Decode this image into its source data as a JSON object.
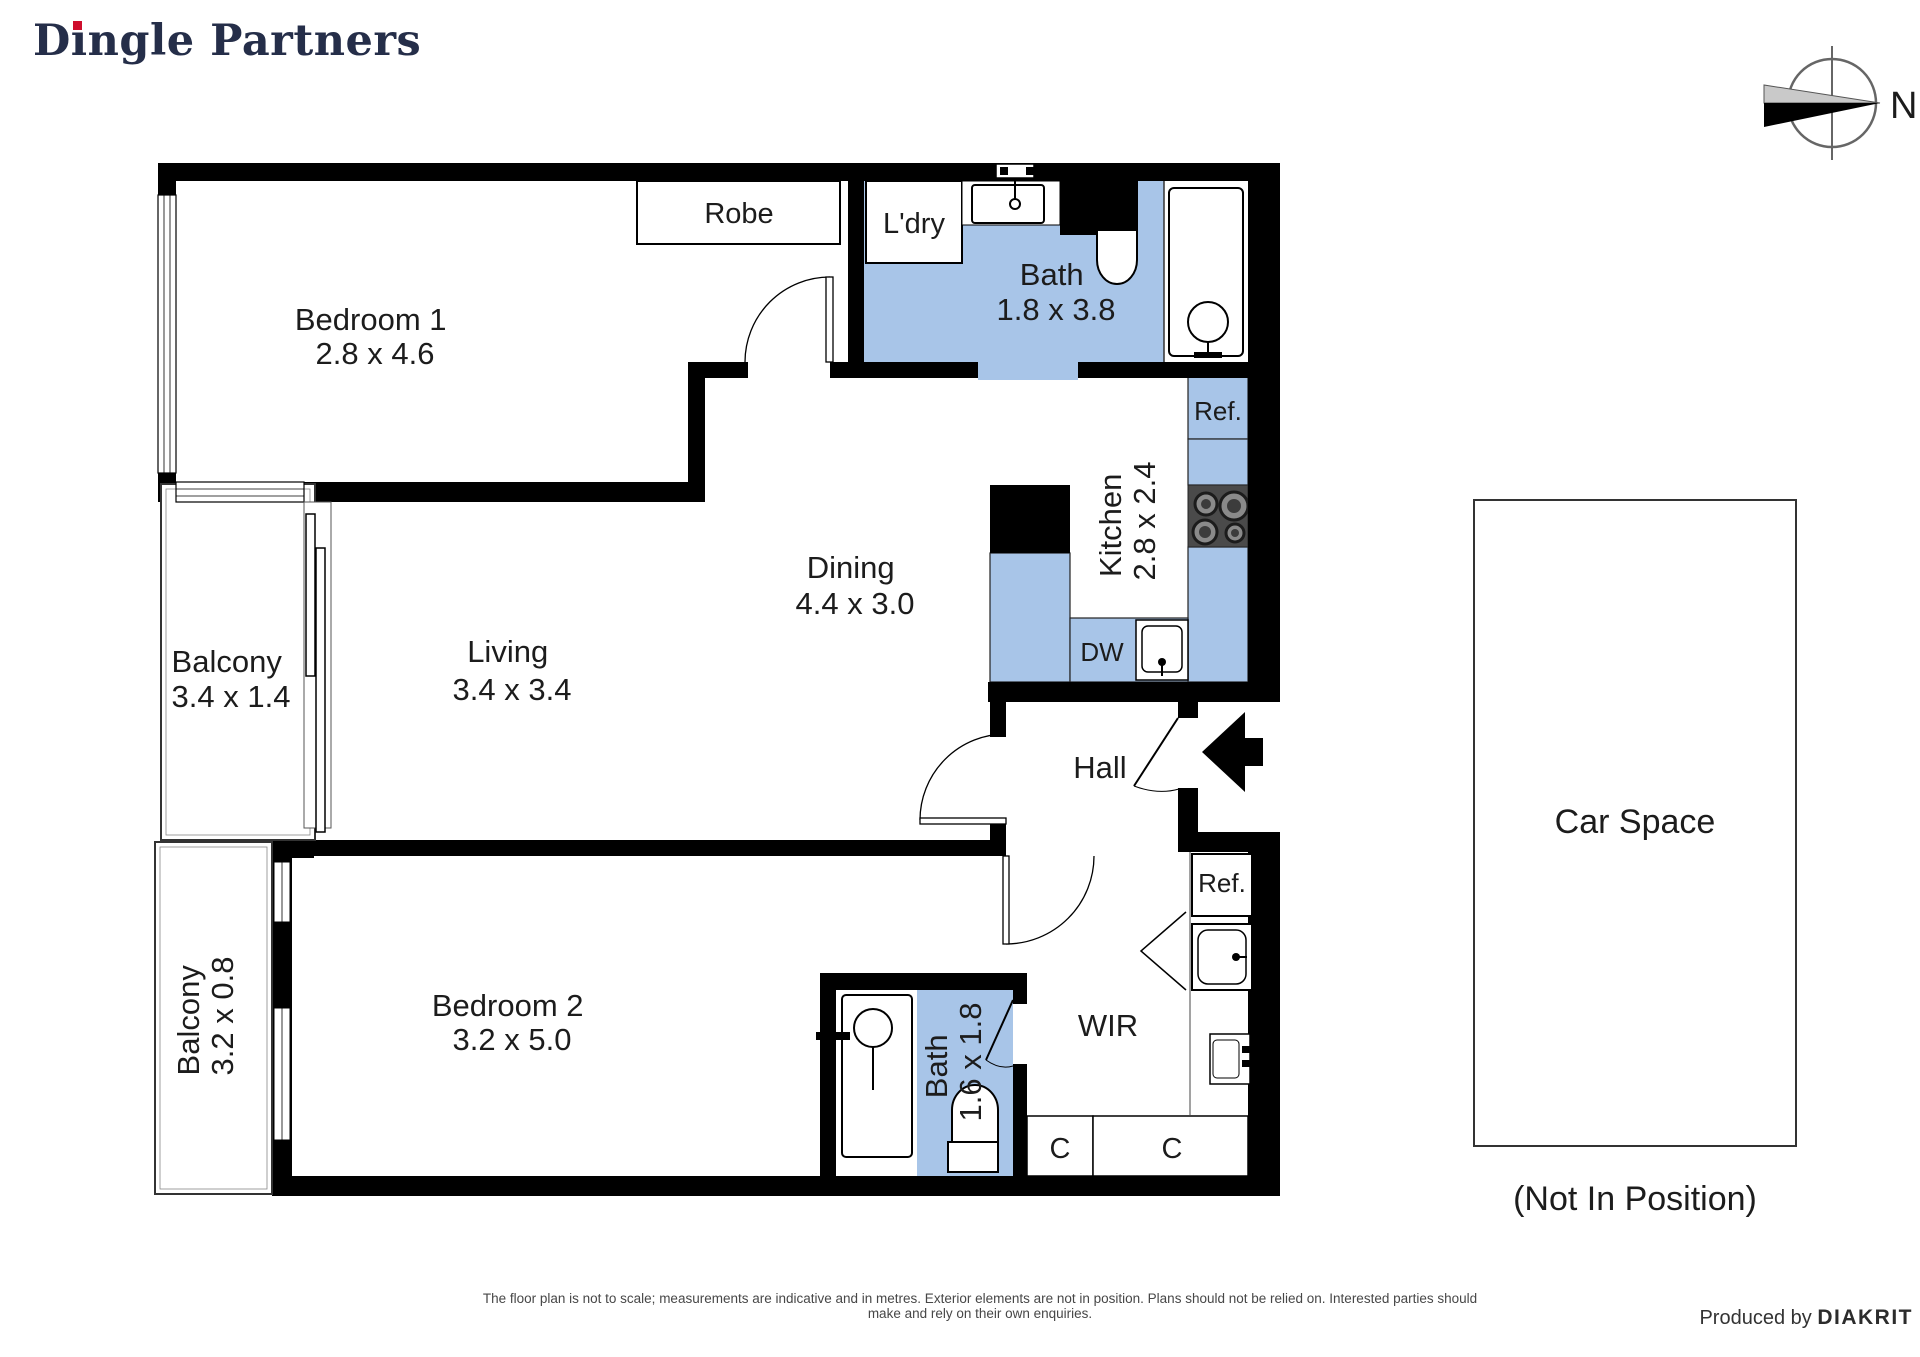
{
  "header": {
    "brand_prefix": "D",
    "brand_i": "ı",
    "brand_suffix": "ngle Partners",
    "compass_north_label": "N"
  },
  "rooms": {
    "bedroom1": {
      "label": "Bedroom 1",
      "dims": "2.8 x 4.6"
    },
    "bedroom2": {
      "label": "Bedroom 2",
      "dims": "3.2 x 5.0"
    },
    "living": {
      "label": "Living",
      "dims": "3.4 x 3.4"
    },
    "dining": {
      "label": "Dining",
      "dims": "4.4 x 3.0"
    },
    "kitchen": {
      "label": "Kitchen",
      "dims": "2.8 x 2.4"
    },
    "bath1": {
      "label": "Bath",
      "dims": "1.8 x 3.8"
    },
    "bath2": {
      "label": "Bath",
      "dims": "1.6 x 1.8"
    },
    "balcony1": {
      "label": "Balcony",
      "dims": "3.4 x 1.4"
    },
    "balcony2": {
      "label": "Balcony",
      "dims": "3.2 x 0.8"
    },
    "hall": {
      "label": "Hall"
    },
    "wir": {
      "label": "WIR"
    }
  },
  "fixtures": {
    "robe": "Robe",
    "laundry": "L'dry",
    "fridge1": "Ref.",
    "fridge2": "Ref.",
    "dishwasher": "DW",
    "cupboard1": "C",
    "cupboard2": "C"
  },
  "car_space": {
    "label": "Car Space",
    "caption": "(Not In Position)"
  },
  "footer": {
    "disclaimer": "The floor plan is not to scale; measurements are indicative and in metres. Exterior elements are not in position. Plans should not be relied on. Interested parties should make and rely on their own enquiries.",
    "produced_by": "Produced by ",
    "producer": "DIAKRIT"
  },
  "colors": {
    "wet_area": "#a8c5e8",
    "wall": "#000000",
    "logo_navy": "#252e49",
    "logo_red": "#ce0e2d"
  }
}
